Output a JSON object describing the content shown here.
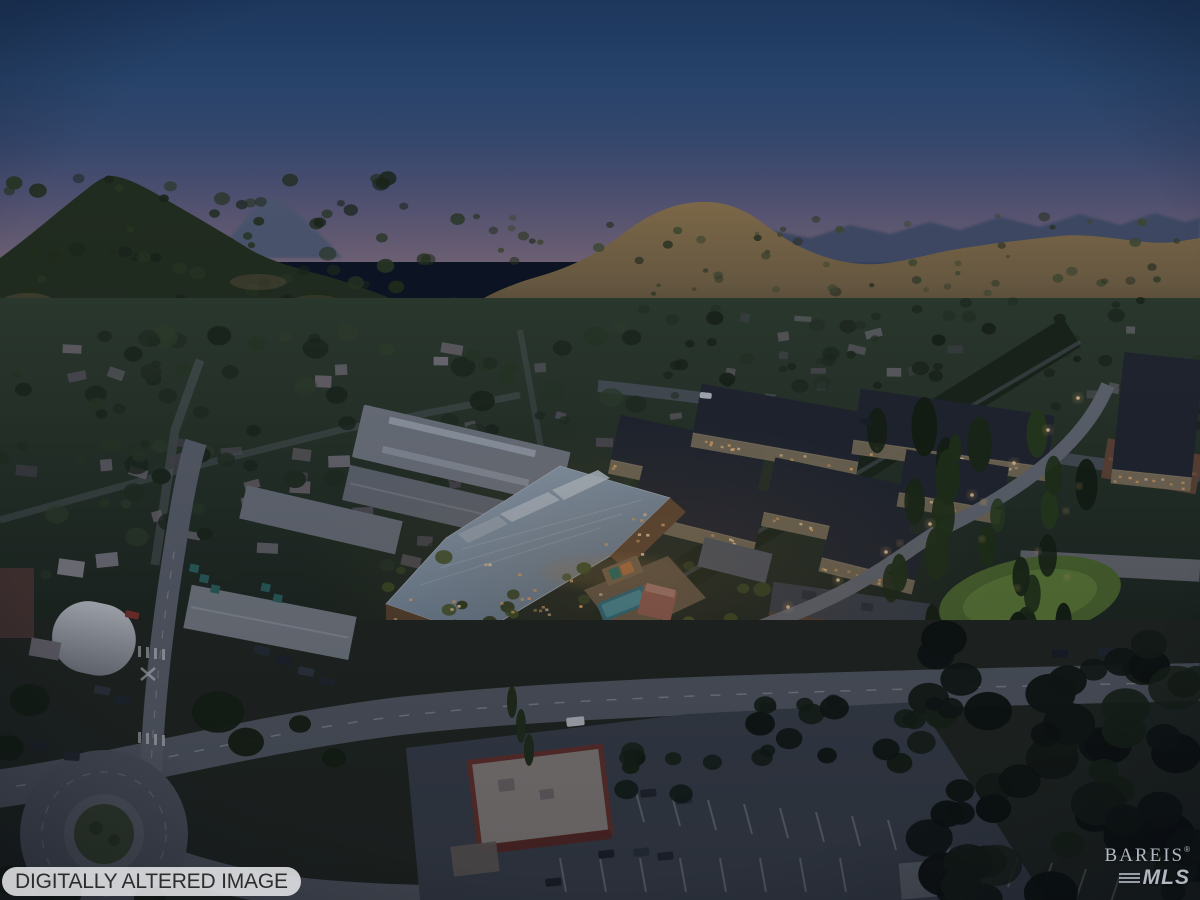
{
  "photo": {
    "description": "Aerial twilight view of a riverside town: a new mixed-use development rendering with a large silver-roofed lodge, lit apartment blocks, pool courtyard and landscaped streets, set before wooded hills, golden mountains and a dusk sky",
    "badge_label": "DIGITALLY ALTERED IMAGE",
    "watermark": {
      "brand": "BAREIS",
      "registered_mark": "®",
      "suffix": "MLS"
    },
    "colors": {
      "sky_top": "#1e3a62",
      "sky_horizon": "#837184",
      "hill_gold": "#8a734c",
      "forest_dark": "#25301d",
      "roof_silver": "#9db0c2",
      "window_glow": "#f2b469",
      "pool": "#4d9dac",
      "badge_bg": "#e4e5e7",
      "badge_text": "#2d2d2d",
      "watermark_text": "#cfd5e1"
    }
  }
}
